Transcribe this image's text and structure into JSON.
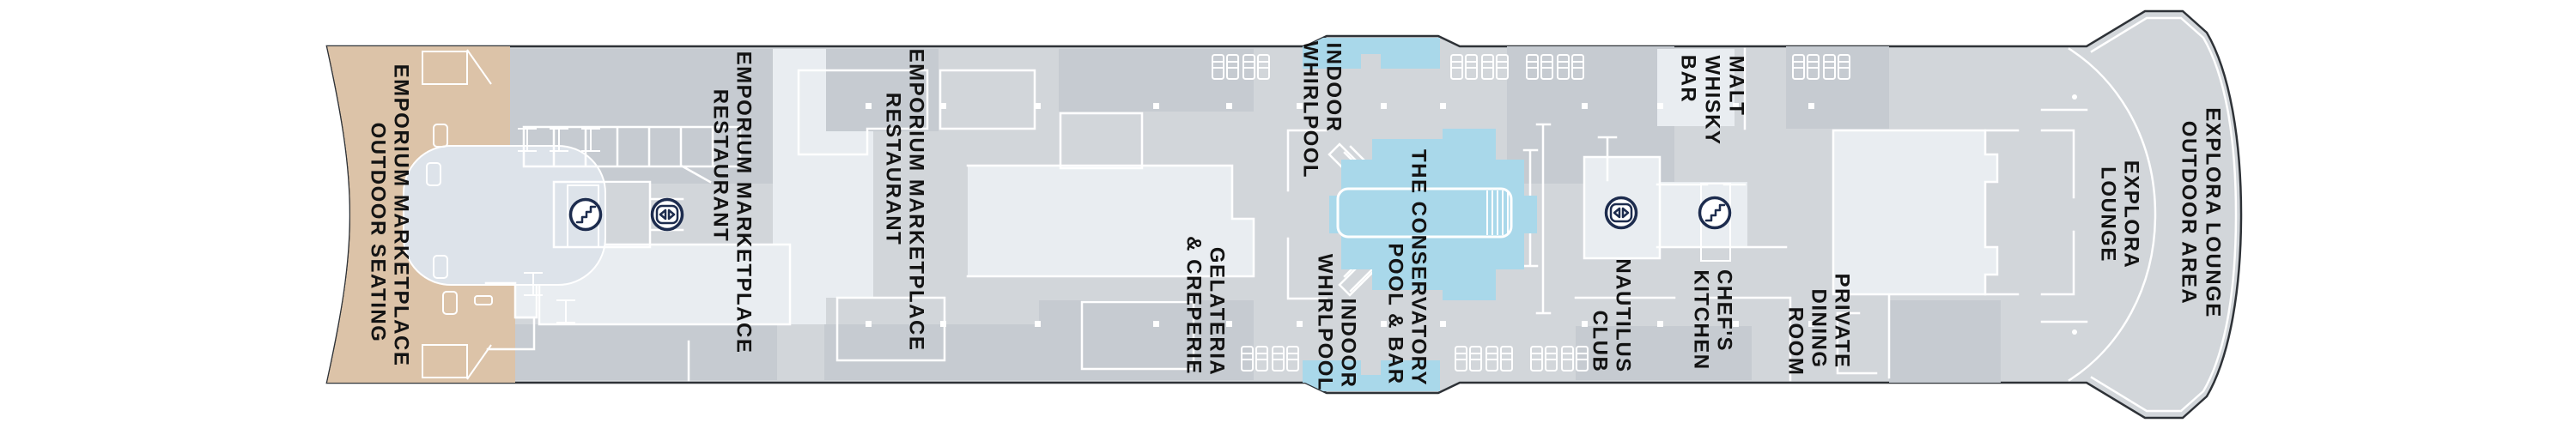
{
  "colors": {
    "deck_base": "#d2d6da",
    "deck_dark": "#c6cbd1",
    "deck_light": "#e9edf1",
    "tan": "#dcc3a8",
    "blob": "#dde3ea",
    "pool_blue": "#a9d8ea",
    "icon_navy": "#1d2c4e",
    "wall_white": "#ffffff",
    "hull_outline": "#2e3237",
    "label_ink": "#131313"
  },
  "rooms": {
    "emporium_outdoor": {
      "lines": [
        "EMPORIUM MARKETPLACE",
        "OUTDOOR SEATING"
      ]
    },
    "emporium_restaurant_fwd": {
      "lines": [
        "EMPORIUM MARKETPLACE",
        "RESTAURANT"
      ]
    },
    "emporium_restaurant_mid": {
      "lines": [
        "EMPORIUM MARKETPLACE",
        "RESTAURANT"
      ]
    },
    "gelateria": {
      "lines": [
        "GELATERIA",
        "& CREPERIE"
      ]
    },
    "indoor_whirlpool_top": {
      "lines": [
        "INDOOR",
        "WHIRLPOOL"
      ]
    },
    "indoor_whirlpool_bottom": {
      "lines": [
        "INDOOR",
        "WHIRLPOOL"
      ]
    },
    "conservatory_pool": {
      "lines": [
        "THE CONSERVATORY",
        "POOL & BAR"
      ]
    },
    "malt_whisky_bar": {
      "lines": [
        "MALT",
        "WHISKY",
        "BAR"
      ]
    },
    "nautilus_club": {
      "lines": [
        "NAUTILUS",
        "CLUB"
      ]
    },
    "chefs_kitchen": {
      "lines": [
        "CHEF'S",
        "KITCHEN"
      ]
    },
    "private_dining": {
      "lines": [
        "PRIVATE",
        "DINING",
        "ROOM"
      ]
    },
    "explora_lounge": {
      "lines": [
        "EXPLORA",
        "LOUNGE"
      ]
    },
    "explora_lounge_outdoor": {
      "lines": [
        "EXPLORA LOUNGE",
        "OUTDOOR AREA"
      ]
    }
  },
  "icons": {
    "stairs": "stairs",
    "elevator": "elevator"
  }
}
